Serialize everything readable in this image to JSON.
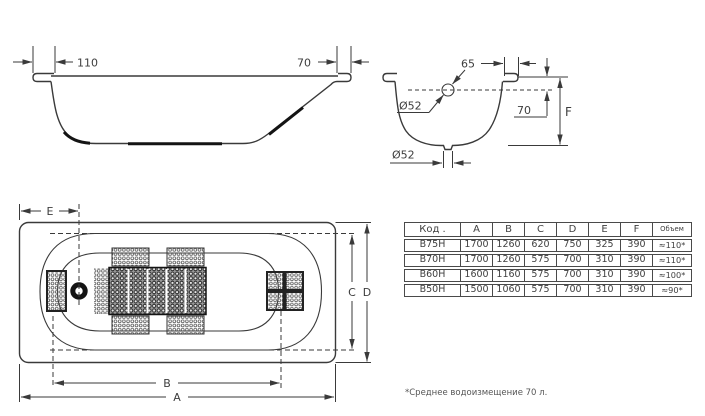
{
  "side_view": {
    "dim_overhang_left": "110",
    "dim_overhang_right": "70"
  },
  "cross_section": {
    "dim_rim": "65",
    "overflow_diameter_label": "Ø52",
    "dim_overflow_depth": "70",
    "depth_label": "F",
    "drain_diameter_label": "Ø52"
  },
  "top_view": {
    "dim_e": "E",
    "dim_c": "C",
    "dim_d": "D",
    "dim_b": "B",
    "dim_a": "A"
  },
  "table": {
    "headers": [
      "Код .",
      "A",
      "B",
      "C",
      "D",
      "E",
      "F",
      "Объем"
    ],
    "rows": [
      [
        "В75Н",
        "1700",
        "1260",
        "620",
        "750",
        "325",
        "390",
        "≈110*"
      ],
      [
        "В70Н",
        "1700",
        "1260",
        "575",
        "700",
        "310",
        "390",
        "≈110*"
      ],
      [
        "В60Н",
        "1600",
        "1160",
        "575",
        "700",
        "310",
        "390",
        "≈100*"
      ],
      [
        "В50Н",
        "1500",
        "1060",
        "575",
        "700",
        "310",
        "390",
        "≈90*"
      ]
    ]
  },
  "footnote": "*Среднее водоизмещение 70 л.",
  "colors": {
    "line": "#3a3a3a",
    "text": "#3d3d3d",
    "background": "#ffffff"
  }
}
